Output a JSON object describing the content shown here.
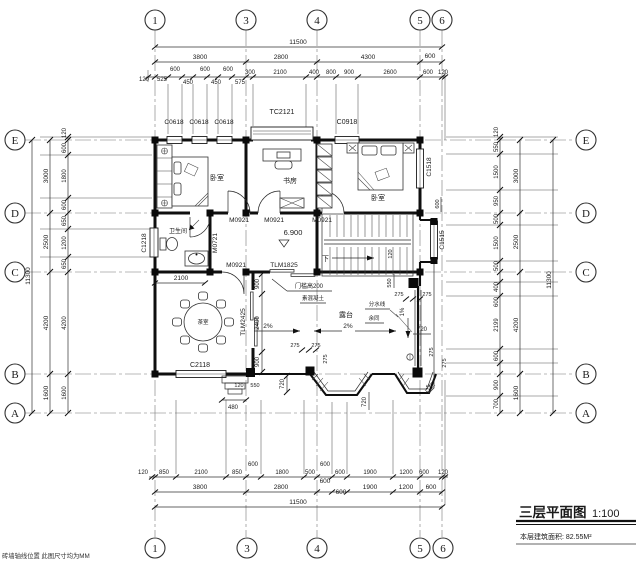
{
  "title_block": {
    "title": "三层平面图",
    "scale": "1:100",
    "area_note": "本层建筑面积: 82.55M²"
  },
  "footnote": "砖墙轴线位置 此图尺寸均为MM",
  "grid": {
    "cols": [
      "1",
      "3",
      "4",
      "5",
      "6"
    ],
    "rows": [
      "E",
      "D",
      "C",
      "B",
      "A"
    ]
  },
  "rooms": {
    "bedroom_left": "卧室",
    "study": "书房",
    "bedroom_right": "卧室",
    "bathroom": "卫生间",
    "tea_room": "茶室",
    "terrace": "露台"
  },
  "openings": {
    "c0618": "C0618",
    "tc2121": "TC2121",
    "c0918": "C0918",
    "c1218": "C1218",
    "c1518": "C1518",
    "c1515": "C1515",
    "c2118": "C2118",
    "m0921": "M0921",
    "m0721": "M0721",
    "tlm1825": "TLM1825",
    "tlm2425": "TLM2425"
  },
  "notes": {
    "level": "6.900",
    "down": "下",
    "threshold": "门槛高200",
    "concrete": "素混凝土",
    "divide": "分水线",
    "rest_same": "余同",
    "slope2": "2%",
    "slope1": "1%"
  },
  "dims": {
    "top1": [
      "11500"
    ],
    "top2": [
      "3800",
      "2800",
      "4300",
      "600"
    ],
    "top3": [
      "120",
      "525",
      "600",
      "450",
      "600",
      "450",
      "600",
      "575",
      "300",
      "2100",
      "400",
      "800",
      "900",
      "2600",
      "600",
      "120"
    ],
    "bottom1": [
      "120",
      "850",
      "2100",
      "850",
      "600",
      "1800",
      "500",
      "600",
      "600",
      "1900",
      "1200",
      "600",
      "120"
    ],
    "bottom2": [
      "3800",
      "2800",
      "600",
      "600",
      "1900",
      "1200",
      "600"
    ],
    "bottom3": [
      "11500"
    ],
    "left_small": [
      "120",
      "600",
      "1800",
      "600",
      "650",
      "1200",
      "650",
      "4200",
      "1600"
    ],
    "left_seg": [
      "3000",
      "2500",
      "4200",
      "1600"
    ],
    "left_total": [
      "11300"
    ],
    "right_small": [
      "120",
      "550",
      "1500",
      "950",
      "500",
      "1500",
      "500",
      "400",
      "600",
      "2199",
      "600",
      "900",
      "700"
    ],
    "right_seg": [
      "3000",
      "2500",
      "4200",
      "1600"
    ],
    "right_total": [
      "11300"
    ],
    "inner": {
      "bath": "2100",
      "v900a": "900",
      "v2400": "2400",
      "v900b": "900",
      "v720": "720",
      "h720": "720",
      "p275": "275",
      "s120": "120",
      "s550": "550",
      "s480": "480",
      "t550": "550",
      "stair120": "120",
      "bay600": "600"
    }
  }
}
